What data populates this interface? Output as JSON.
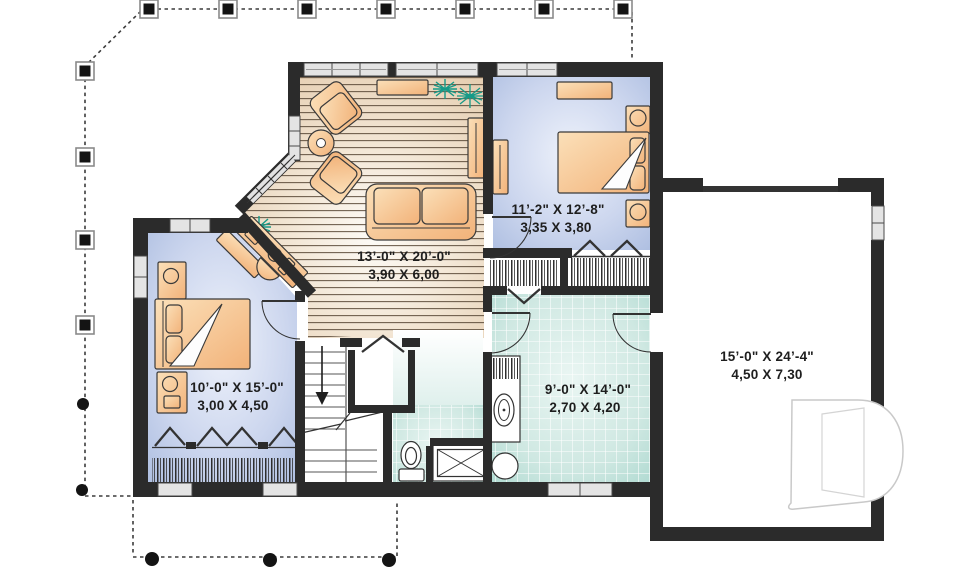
{
  "floor_plan": {
    "rooms": {
      "living_room": {
        "dim_imperial": "13’-0\" X 20’-0\"",
        "dim_metric": "3,90 X 6,00"
      },
      "bedroom_top": {
        "dim_imperial": "11’-2\" X 12’-8\"",
        "dim_metric": "3,35 X 3,80"
      },
      "bedroom_left": {
        "dim_imperial": "10’-0\" X 15’-0\"",
        "dim_metric": "3,00 X 4,50"
      },
      "bathroom": {
        "dim_imperial": "9’-0\" X 14’-0\"",
        "dim_metric": "2,70 X 4,20"
      },
      "garage": {
        "dim_imperial": "15’-0\" X 24’-4\"",
        "dim_metric": "4,50 X 7,30"
      }
    },
    "colors": {
      "wall": "#2b2b2b",
      "bedroom_floor": "#b9c7e6",
      "living_floor": "#e9d5bd",
      "tile": "#cfe8e2",
      "furniture": "#f7c38d",
      "plant": "#169a88",
      "porch_line": "#3c3c3c",
      "logo_outline": "#c9c9c9",
      "label_text": "#1e1e1e"
    },
    "icons": {
      "porch_post": "square-post",
      "porch_column": "round-column",
      "stairs_direction": "down-arrow",
      "shower": "x-square",
      "closet": "hanging-rod-hatch",
      "logo": "drummond-d-watermark"
    }
  }
}
